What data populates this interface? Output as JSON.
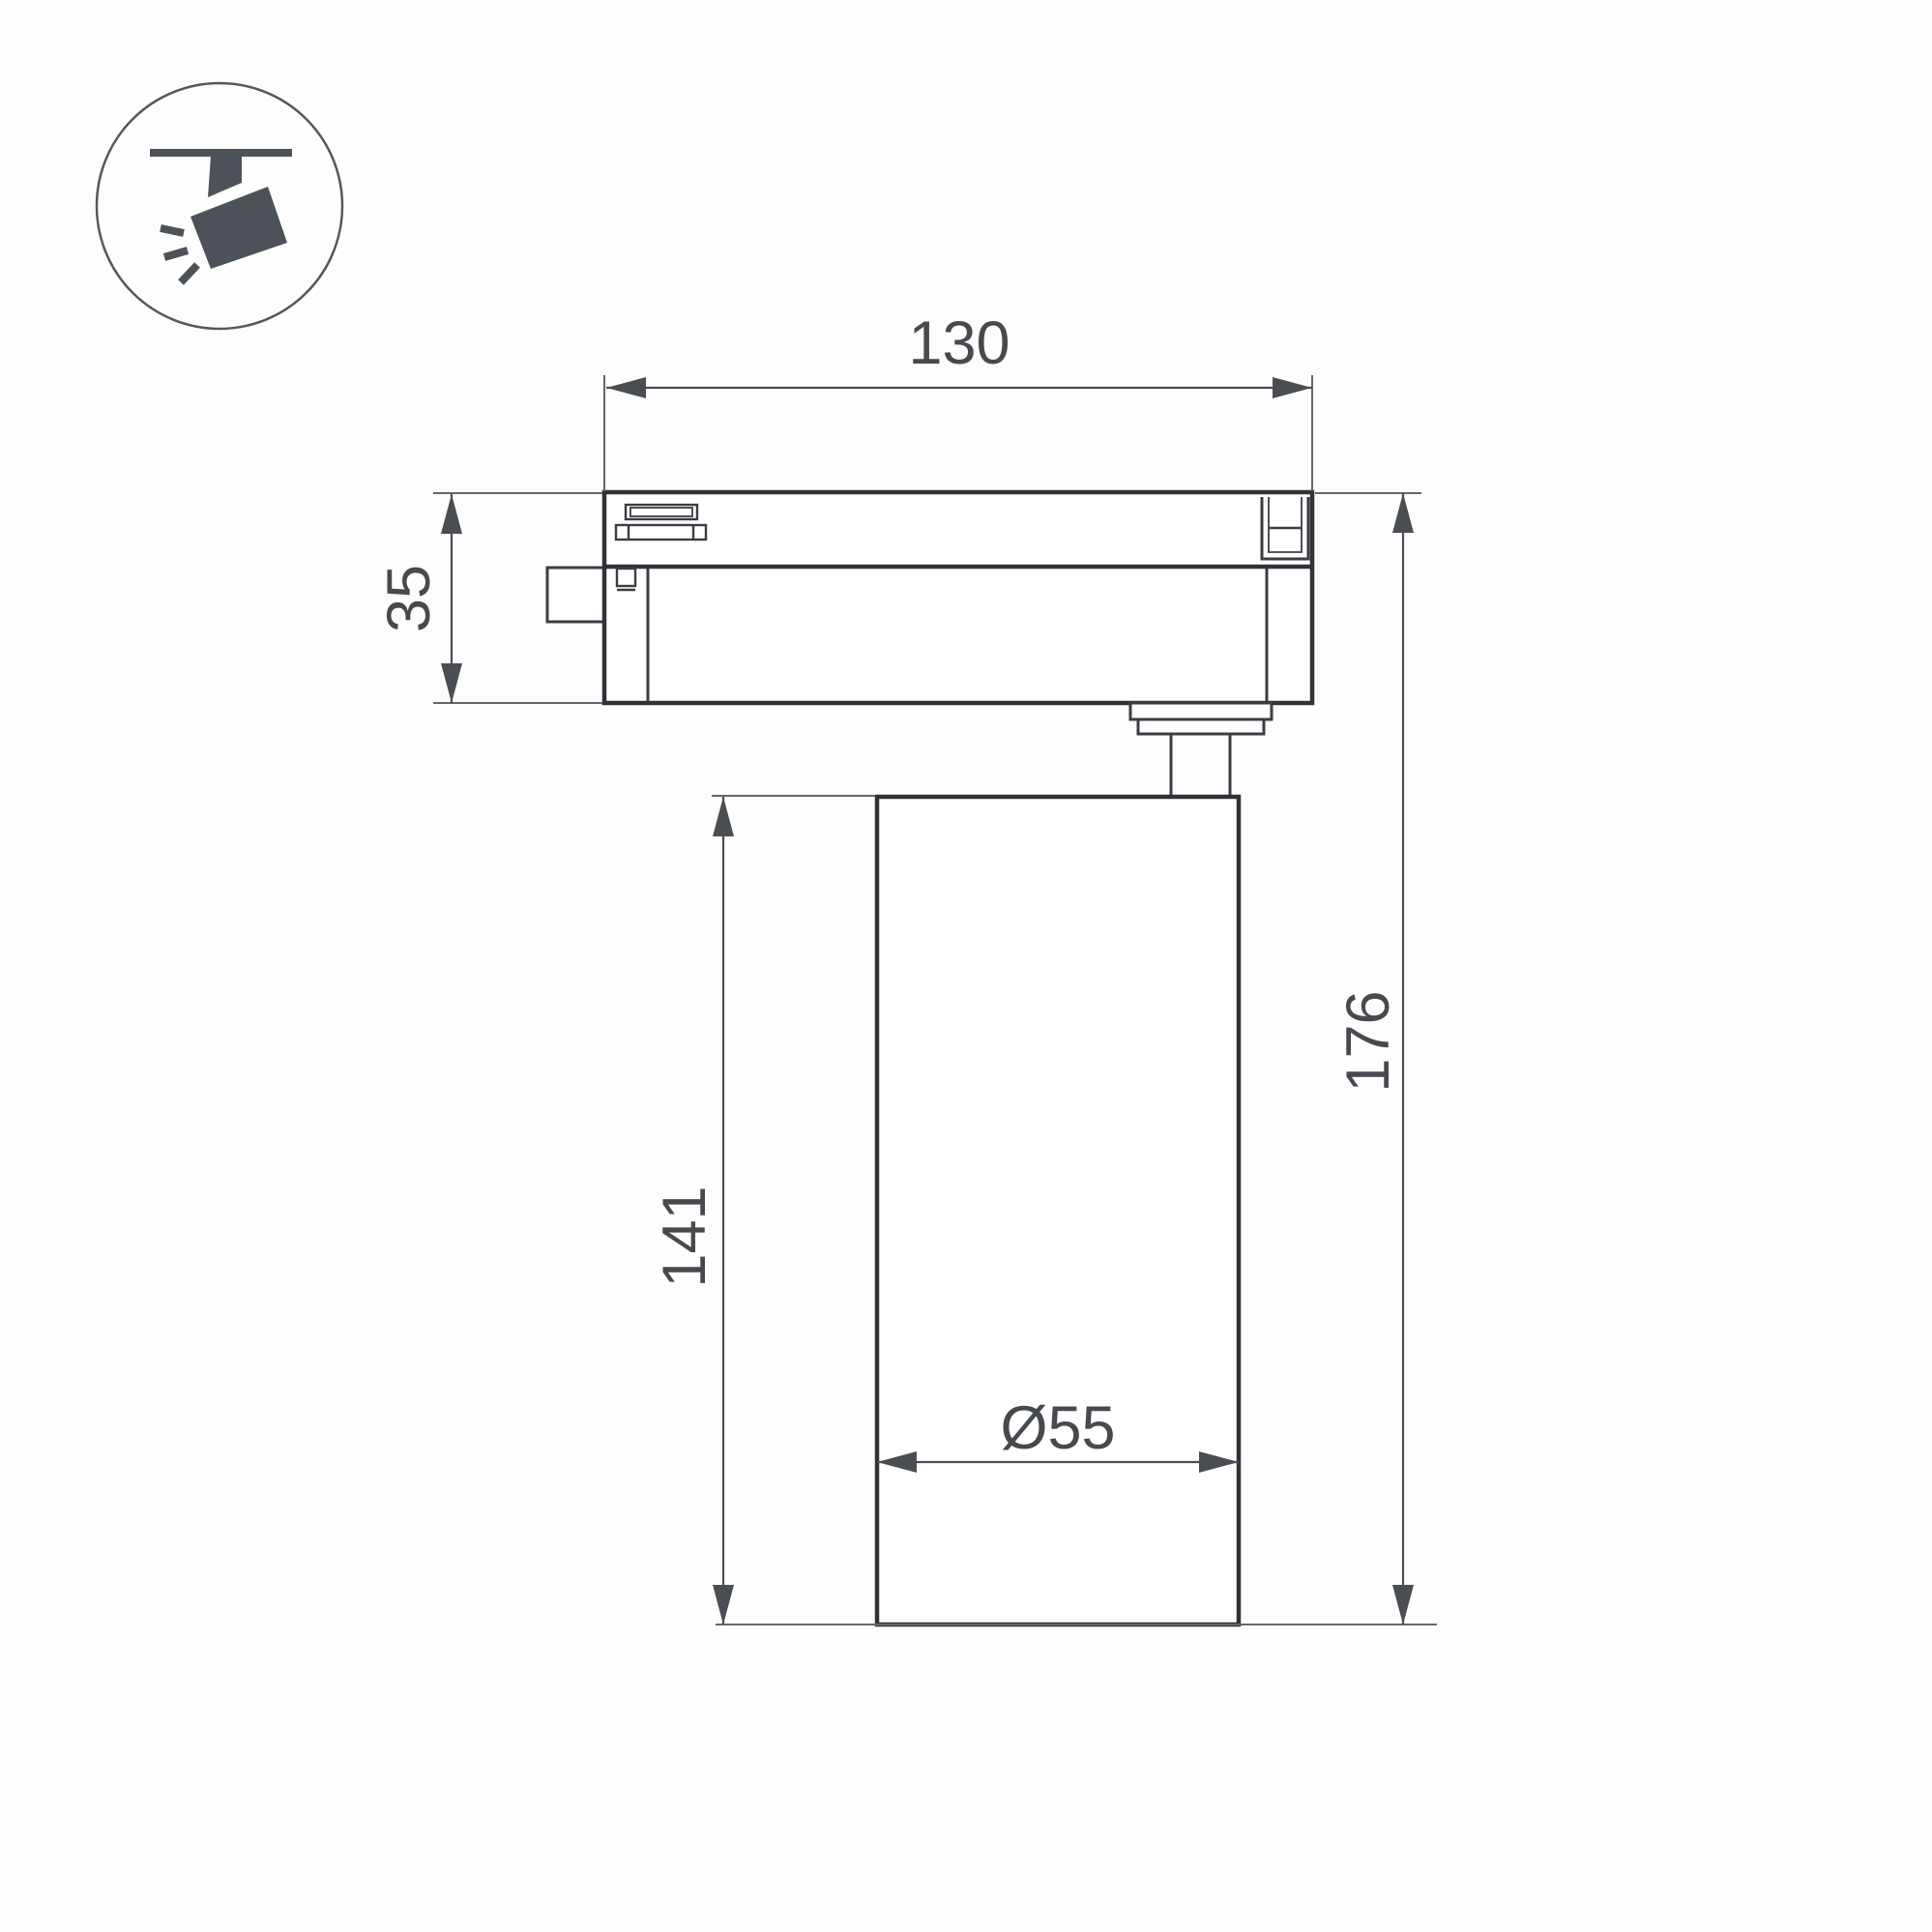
{
  "page": {
    "type": "technical-dimension-drawing",
    "subject": "Track-mounted LED spotlight, side elevation with dimensions"
  },
  "icon": {
    "name": "track-spotlight-icon",
    "description": "pictogram of a spotlight hanging from a ceiling track, tilted, with light rays"
  },
  "dimensions": {
    "adapter_width": {
      "label": "130"
    },
    "adapter_height": {
      "label": "35"
    },
    "body_height": {
      "label": "141"
    },
    "overall_height": {
      "label": "176"
    },
    "body_diameter": {
      "label": "Ø55"
    }
  },
  "colors": {
    "background": "#fdfdfd",
    "outline_bold": "#2f3338",
    "outline_medium": "#3a3e43",
    "dimension_line": "#4a4e52",
    "extension_line": "#63676b",
    "text": "#46494d",
    "icon_fill": "#4c5257",
    "icon_ring": "#54585c"
  }
}
